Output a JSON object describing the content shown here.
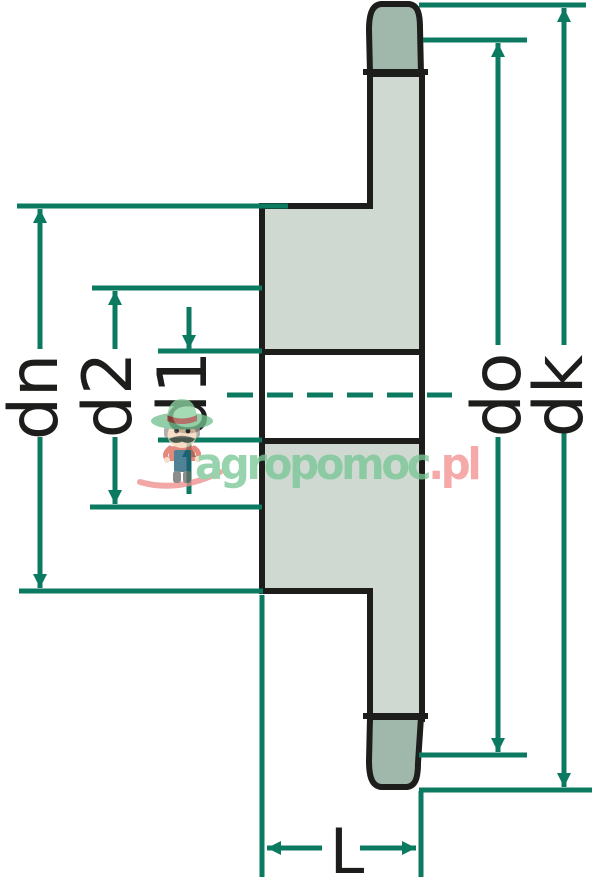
{
  "page": {
    "title": "Sprocket cross-section dimension drawing"
  },
  "dimensions": {
    "dn": "dn",
    "d2": "d2",
    "d1": "d1",
    "do": "do",
    "dk": "dk",
    "L": "L"
  },
  "watermark": {
    "brand_green": "agropomoc",
    "brand_pink": ".pl"
  },
  "colors": {
    "dimension_teal": "#0c7a61",
    "outline_dark": "#1d1d1b",
    "body_fill": "#cfd9d2",
    "tooth_fill": "#a0b7ab",
    "watermark_green": "#7ac797",
    "watermark_pink": "#f49292",
    "swoosh_pink": "#ee8f8e"
  }
}
